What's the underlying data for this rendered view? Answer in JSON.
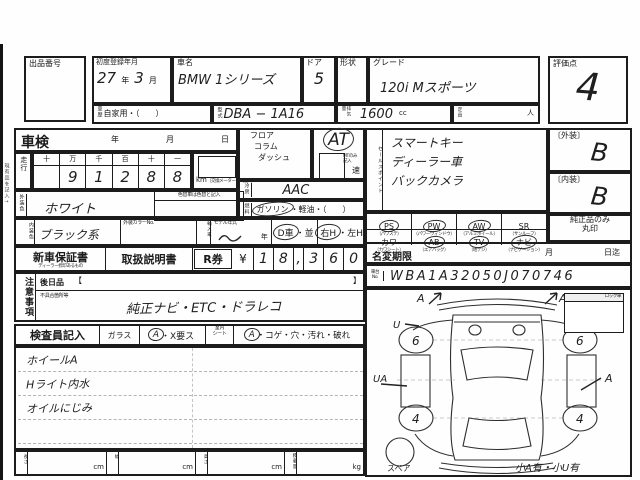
{
  "header": {
    "lot_label": "出品番号",
    "first_reg_label": "初度登録年月",
    "first_reg_year": "27",
    "first_reg_year_unit": "年",
    "first_reg_month": "3",
    "first_reg_month_unit": "月",
    "car_name_label": "車名",
    "car_name_value": "BMW 1シリーズ",
    "door_label": "ドア",
    "door_value": "5",
    "shape_label": "形状",
    "grade_label": "グレード",
    "grade_value": "120i Mスポーツ",
    "score_label": "評価点",
    "score_value": "4",
    "history_label": "車歴",
    "history_value": "自家用・（　　）",
    "model_label": "型式",
    "model_value": "DBA − 1A16",
    "disp_label": "排気量",
    "disp_value": "1600",
    "disp_unit": "cc",
    "capacity_label": "定員",
    "capacity_unit": "人"
  },
  "shaken": {
    "label": "車検",
    "year": "年",
    "month": "月",
    "day": "日"
  },
  "mileage": {
    "label": "走行",
    "digit_headers": [
      "十",
      "万",
      "千",
      "百",
      "十",
      "一"
    ],
    "digits": [
      "",
      "9",
      "1",
      "2",
      "8",
      "8"
    ],
    "unit": "km",
    "unit_note": "（交換メーター等−記入）"
  },
  "transmission": {
    "opt1": "フロア",
    "opt2": "コラム",
    "opt3": "ダッシュ",
    "value": "AT",
    "at_circled": true,
    "mt_note": "MTのみ記入",
    "mt_unit": "速"
  },
  "aircon": {
    "label": "冷房",
    "value": "AAC"
  },
  "fuel": {
    "label": "燃料",
    "opt1": "ガソリン",
    "sep": "・",
    "opt2": "軽油",
    "rest": "・（　　）",
    "opt1_circled": true
  },
  "ext_color": {
    "label": "外装色",
    "value": "ホワイト",
    "change_note": "色替車は色替と記入"
  },
  "int_color": {
    "label": "内装色",
    "value": "ブラック系"
  },
  "color_no": {
    "label": "外装カラーNo."
  },
  "import_car": {
    "label": "輸入車"
  },
  "model_year": {
    "label": "モデル年式",
    "unit": "年"
  },
  "dealer": {
    "opt1": "D車",
    "sep": "・",
    "opt2": "並",
    "opt1_circled": true
  },
  "handle": {
    "opt1": "右H",
    "sep": "・",
    "opt2": "左H",
    "opt1_circled": true
  },
  "sales_point": {
    "label": "セールスポイント",
    "line1": "スマートキー",
    "line2": "ディーラー車",
    "line3": "バックカメラ"
  },
  "ratings": {
    "ext_label": "〔外装〕",
    "ext_value": "B",
    "int_label": "〔内装〕",
    "int_value": "B",
    "genuine_line1": "純正品のみ",
    "genuine_line2": "丸印"
  },
  "equipment": {
    "row1": [
      {
        "code": "PS",
        "note": "（パワステ）",
        "checked": true
      },
      {
        "code": "PW",
        "note": "（パワーウィンドウ）",
        "checked": true
      },
      {
        "code": "AW",
        "note": "（アルミホイール）",
        "checked": true
      },
      {
        "code": "SR",
        "note": "（サンルーフ）",
        "checked": false
      }
    ],
    "row2": [
      {
        "code": "カワ",
        "note": "（カワシート）",
        "checked": false
      },
      {
        "code": "AB",
        "note": "（エアバッグ）",
        "checked": true
      },
      {
        "code": "TV",
        "note": "（地デジ）",
        "checked": true
      },
      {
        "code": "ナビ",
        "note": "（ナビゲーション）",
        "checked": true
      }
    ]
  },
  "name_change": {
    "label": "名変期限",
    "month": "月",
    "deadline": "日迄"
  },
  "vin": {
    "label_line1": "車台",
    "label_line2": "No.",
    "value": "WBA1A32050J070746"
  },
  "warranty": {
    "label": "新車保証書",
    "note": "ディーラー捺印あるもの",
    "manual": "取扱説明書",
    "r_label": "R券",
    "yen": "¥",
    "digits": [
      "1",
      "8",
      ",",
      "3",
      "6",
      "0"
    ]
  },
  "caution": {
    "label": "注意事項",
    "later": "後日品",
    "open": "【",
    "close": "】",
    "defect_label": "不具合箇所等",
    "defect_value": "純正ナビ・ETC・ドラレコ"
  },
  "inspector": {
    "label": "検査員記入",
    "glass": "ガラス",
    "glass_opt": "A",
    "glass_circled": true,
    "glass_rest": "・X要ス",
    "seat_line1": "室内",
    "seat_line2": "シート",
    "seat_opt": "A",
    "seat_circled": true,
    "seat_rest": "・コゲ・穴・汚れ・破れ",
    "note1": "ホイールA",
    "note2": "Hライト内水",
    "note3": "オイルにじみ"
  },
  "dims": {
    "length": "長さ",
    "width": "幅",
    "height": "高さ",
    "load": "積載量",
    "cm": "cm",
    "kg": "kg"
  },
  "diagram": {
    "lock": "ロック車",
    "spare": "スペア",
    "legend": "小A有・小U有",
    "wheel_fl": "6",
    "wheel_fr": "6",
    "wheel_rl": "4",
    "wheel_rr": "4",
    "mark_front_left": "A",
    "mark_front_right": "A",
    "mark_left_front": "U",
    "mark_left_mid": "UA",
    "mark_right_mid": "A"
  },
  "margin_note": "現有品を記入→"
}
